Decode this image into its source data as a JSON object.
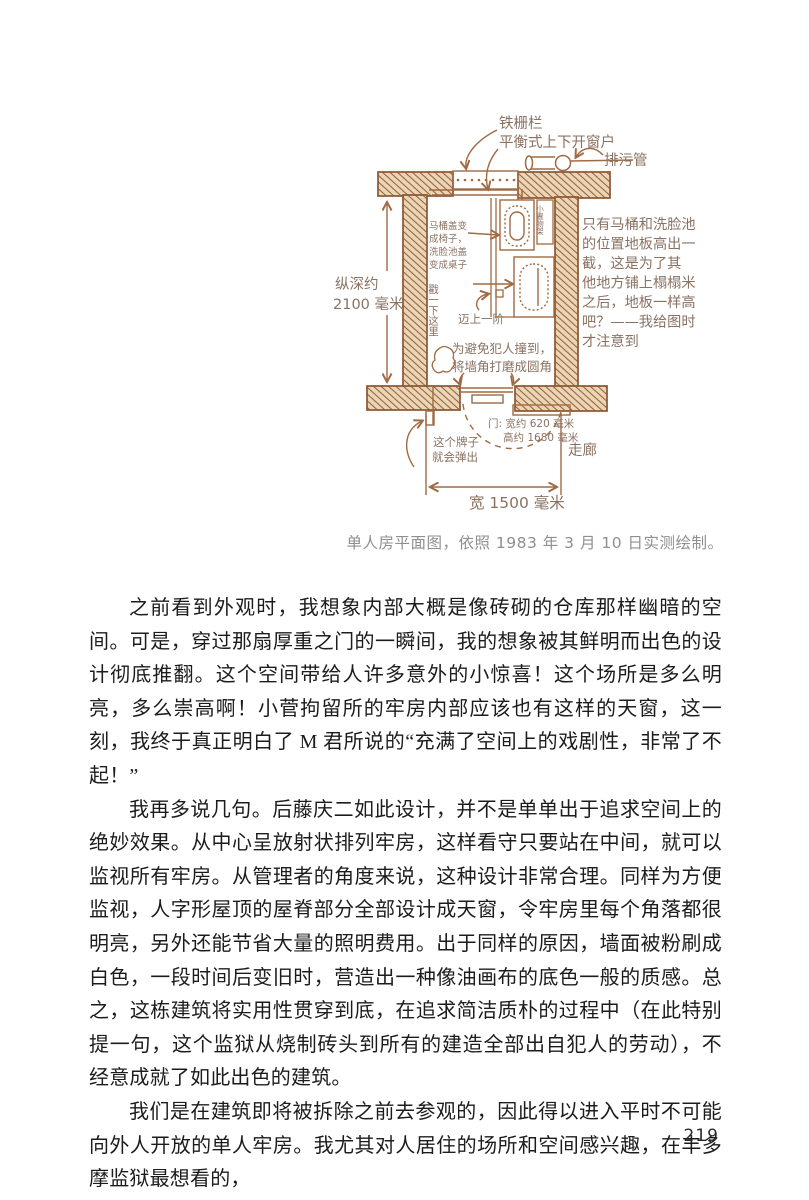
{
  "colors": {
    "ink": "#a06a42",
    "wall_stroke": "#8a5632",
    "wall_fill": "#ead6b6",
    "diagram_text": "#8a7263",
    "caption_gray": "#8f8f8f",
    "body_text": "#1c1c1c"
  },
  "diagram": {
    "labels": {
      "iron_grille": "铁栅栏",
      "balanced_window": "平衡式上下开窗户",
      "drain_pipe": "排污管",
      "depth": [
        "纵深约",
        "2100 毫米"
      ],
      "toilet_note": [
        "马桶盖变",
        "成椅子，",
        "洗脸池盖",
        "变成桌子"
      ],
      "shelf": "小置物架",
      "poke_here": "戳一下这里",
      "step_up": "迈上一阶",
      "corner_note": [
        "为避免犯人撞到，",
        "将墙角打磨成圆角"
      ],
      "door_note": [
        "门: 宽约 620 毫米",
        "高约 1680 毫米"
      ],
      "sign_note": [
        "这个牌子",
        "就会弹出"
      ],
      "corridor": "走廊",
      "width": "宽 1500 毫米",
      "floor_note": [
        "只有马桶和洗脸池",
        "的位置地板高出一",
        "截，这是为了其",
        "他地方铺上榻榻米",
        "之后，地板一样高",
        "吧？——我给图时",
        "才注意到"
      ]
    },
    "caption": "单人房平面图，依照 1983 年 3 月 10 日实测绘制。"
  },
  "body": {
    "paragraphs": [
      "之前看到外观时，我想象内部大概是像砖砌的仓库那样幽暗的空间。可是，穿过那扇厚重之门的一瞬间，我的想象被其鲜明而出色的设计彻底推翻。这个空间带给人许多意外的小惊喜！这个场所是多么明亮，多么崇高啊！小菅拘留所的牢房内部应该也有这样的天窗，这一刻，我终于真正明白了 M 君所说的“充满了空间上的戏剧性，非常了不起！”",
      "我再多说几句。后藤庆二如此设计，并不是单单出于追求空间上的绝妙效果。从中心呈放射状排列牢房，这样看守只要站在中间，就可以监视所有牢房。从管理者的角度来说，这种设计非常合理。同样为方便监视，人字形屋顶的屋脊部分全部设计成天窗，令牢房里每个角落都很明亮，另外还能节省大量的照明费用。出于同样的原因，墙面被粉刷成白色，一段时间后变旧时，营造出一种像油画布的底色一般的质感。总之，这栋建筑将实用性贯穿到底，在追求简洁质朴的过程中（在此特别提一句，这个监狱从烧制砖头到所有的建造全部出自犯人的劳动），不经意成就了如此出色的建筑。",
      "我们是在建筑即将被拆除之前去参观的，因此得以进入平时不可能向外人开放的单人牢房。我尤其对人居住的场所和空间感兴趣，在丰多摩监狱最想看的，"
    ]
  },
  "page": {
    "number": "219"
  }
}
